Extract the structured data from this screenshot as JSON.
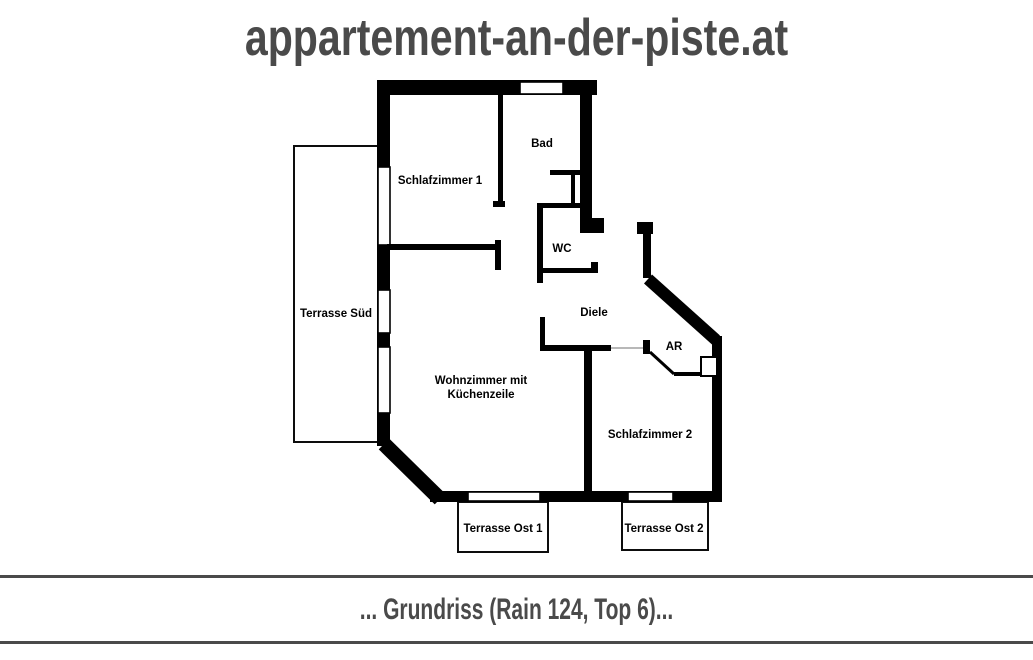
{
  "header": {
    "site_title": "appartement-an-der-piste.at"
  },
  "rooms": {
    "schlafzimmer1": "Schlafzimmer 1",
    "bad": "Bad",
    "wc": "WC",
    "diele": "Diele",
    "ar": "AR",
    "wohnzimmer_line1": "Wohnzimmer mit",
    "wohnzimmer_line2": "Küchenzeile",
    "schlafzimmer2": "Schlafzimmer 2",
    "terrasse_sued": "Terrasse Süd",
    "terrasse_ost1": "Terrasse Ost 1",
    "terrasse_ost2": "Terrasse Ost 2"
  },
  "footer": {
    "caption": "... Grundriss (Rain 124, Top 6)..."
  },
  "colors": {
    "wall": "#000000",
    "title_gray": "#4a4a4a",
    "rule_gray": "#4a4a4a",
    "background": "#ffffff"
  }
}
